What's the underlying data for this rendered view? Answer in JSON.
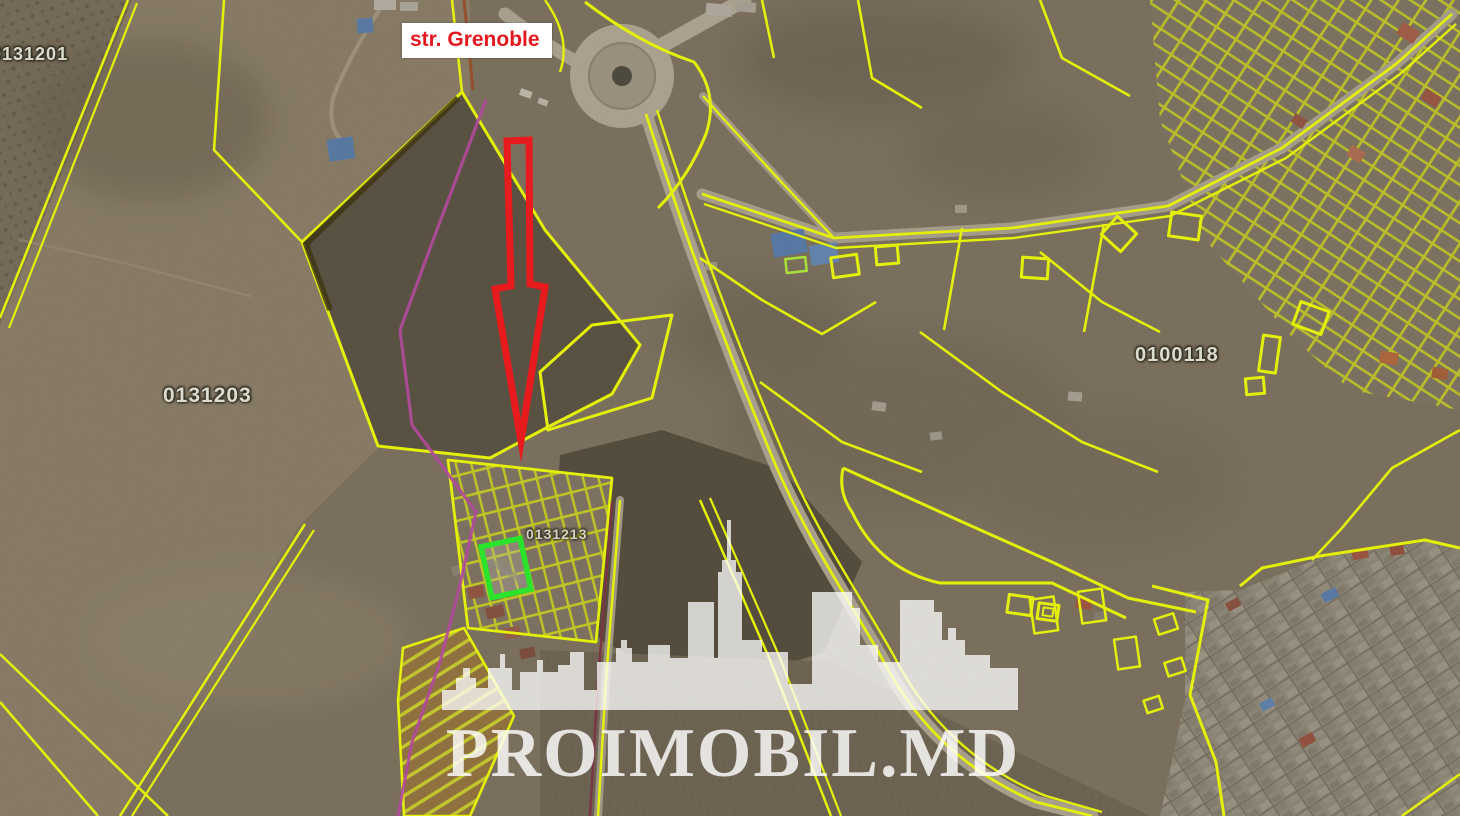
{
  "map": {
    "kind": "satellite-cadastral-map",
    "street_label": {
      "text": "str. Grenoble",
      "color": "#e3191f"
    },
    "parcel_labels": [
      {
        "area": "top-left-field",
        "id": "0131201"
      },
      {
        "area": "left-field",
        "id": "0131203"
      },
      {
        "area": "small-parcels-column",
        "id": "0131213"
      },
      {
        "area": "gardens",
        "id": "0100118"
      }
    ],
    "marker": {
      "type": "down-arrow",
      "color": "#e71b1e"
    },
    "highlight": {
      "type": "selected-parcel",
      "color": "#2ce32c"
    },
    "overlay_colors": {
      "cadastral_line": "#e4ef0a",
      "secondary_boundary": "#b04a9c",
      "road_edge_dark": "#7c3544"
    },
    "watermark": {
      "text": "PROIMOBIL.MD",
      "icon": "city-skyline"
    }
  }
}
